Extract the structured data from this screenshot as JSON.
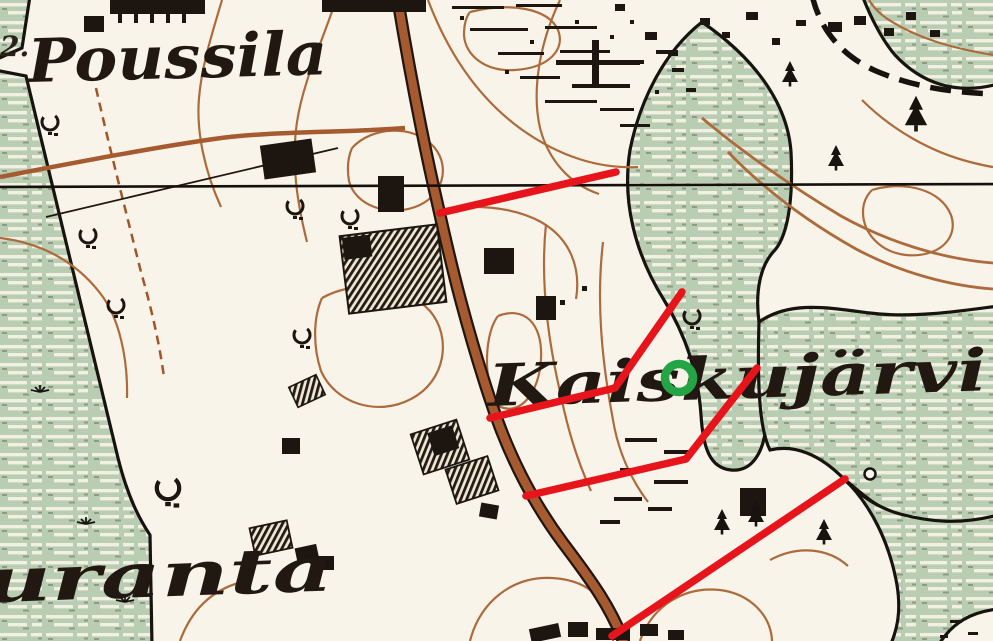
{
  "map": {
    "region_labels": {
      "poussila": "Poussila",
      "kaiskujarvi": "Kaiskujärvi",
      "uranta": "uranta",
      "margin_mark": "2."
    },
    "colors": {
      "paper": "#f8f4ea",
      "marsh_green": "#b9cdb3",
      "contour_brown": "#ad6b3c",
      "road_brown": "#a65a30",
      "ink_black": "#1d1510"
    }
  },
  "annotations": {
    "red_line_color": "#e8141c",
    "red_line_width": 7.5,
    "green_circle_color": "#23a546",
    "green_circle_width": 8.5,
    "red_lines": [
      {
        "id": "red-line-1",
        "points": [
          [
            440,
            213
          ],
          [
            616,
            172
          ]
        ]
      },
      {
        "id": "red-line-2",
        "points": [
          [
            490,
            418
          ],
          [
            615,
            388
          ],
          [
            682,
            292
          ]
        ]
      },
      {
        "id": "red-line-3",
        "points": [
          [
            526,
            496
          ],
          [
            686,
            459
          ],
          [
            757,
            368
          ]
        ]
      },
      {
        "id": "red-line-4",
        "points": [
          [
            845,
            479
          ],
          [
            612,
            636
          ]
        ]
      }
    ],
    "green_circle": {
      "cx": 679,
      "cy": 378,
      "r": 14
    }
  }
}
